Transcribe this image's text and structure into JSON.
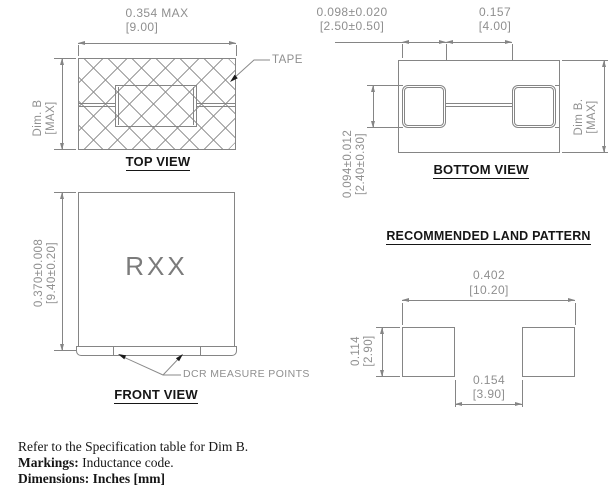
{
  "colors": {
    "line": "#858585",
    "dim_text": "#8f8f8f",
    "ink": "#161616"
  },
  "top_view": {
    "title": "TOP VIEW",
    "dim_width_in": "0.354 MAX",
    "dim_width_mm": "[9.00]",
    "dim_height_line1": "Dim. B",
    "dim_height_line2": "[MAX]",
    "tape_label": "TAPE"
  },
  "bottom_view": {
    "title": "BOTTOM VIEW",
    "dim_pad_width_in": "0.098±0.020",
    "dim_pad_width_mm": "[2.50±0.50]",
    "dim_gap_in": "0.157",
    "dim_gap_mm": "[4.00]",
    "dim_pad_height_in": "0.094±0.012",
    "dim_pad_height_mm": "[2.40±0.30]",
    "dim_height_line1": "Dim B.",
    "dim_height_line2": "[MAX]"
  },
  "front_view": {
    "title": "FRONT VIEW",
    "marking": "RXX",
    "dim_height_in": "0.370±0.008",
    "dim_height_mm": "[9.40±0.20]",
    "dcr_label": "DCR MEASURE POINTS"
  },
  "land_pattern": {
    "title": "RECOMMENDED LAND PATTERN",
    "dim_overall_in": "0.402",
    "dim_overall_mm": "[10.20]",
    "dim_pad_height_in": "0.114",
    "dim_pad_height_mm": "[2.90]",
    "dim_gap_in": "0.154",
    "dim_gap_mm": "[3.90]"
  },
  "notes": {
    "line1": "Refer to the Specification table for Dim B.",
    "line2_label": "Markings:",
    "line2_text": " Inductance code.",
    "line3": "Dimensions: Inches [mm]"
  }
}
